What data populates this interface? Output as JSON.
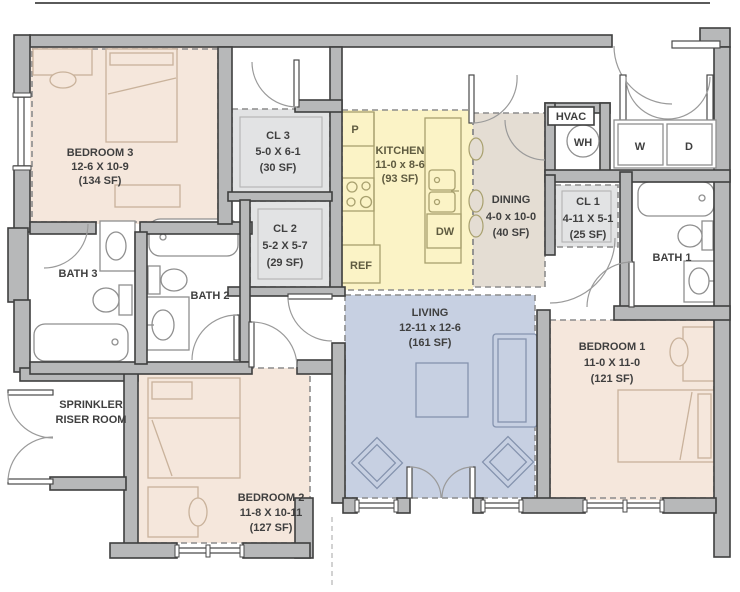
{
  "plan": {
    "title": "Unit floor plan",
    "rooms": {
      "bedroom3": {
        "name": "BEDROOM 3",
        "dims": "12-6 X 10-9",
        "area": "(134 SF)"
      },
      "bedroom2": {
        "name": "BEDROOM 2",
        "dims": "11-8 X 10-11",
        "area": "(127 SF)"
      },
      "bedroom1": {
        "name": "BEDROOM 1",
        "dims": "11-0 X 11-0",
        "area": "(121 SF)"
      },
      "living": {
        "name": "LIVING",
        "dims": "12-11 x 12-6",
        "area": "(161 SF)"
      },
      "kitchen": {
        "name": "KITCHEN",
        "dims": "11-0 x 8-6",
        "area": "(93 SF)"
      },
      "dining": {
        "name": "DINING",
        "dims": "4-0 x 10-0",
        "area": "(40 SF)"
      },
      "cl1": {
        "name": "CL 1",
        "dims": "4-11 X 5-1",
        "area": "(25 SF)"
      },
      "cl2": {
        "name": "CL 2",
        "dims": "5-2 X 5-7",
        "area": "(29 SF)"
      },
      "cl3": {
        "name": "CL 3",
        "dims": "5-0 X 6-1",
        "area": "(30 SF)"
      },
      "bath1": {
        "name": "BATH 1"
      },
      "bath2": {
        "name": "BATH 2"
      },
      "bath3": {
        "name": "BATH 3"
      },
      "hvac": {
        "name": "HVAC"
      },
      "sprinkler": {
        "name_line1": "SPRINKLER",
        "name_line2": "RISER ROOM"
      }
    },
    "appliances": {
      "pantry": "P",
      "refrigerator": "REF",
      "dishwasher": "DW",
      "water_heater": "WH",
      "washer": "W",
      "dryer": "D"
    },
    "colors": {
      "wall_fill": "#b7b8b9",
      "wall_stroke": "#3f3f3f",
      "bedroom_fill": "#f5e7dc",
      "kitchen_fill": "#fbf3c6",
      "dining_fill": "#e4ddd3",
      "living_fill": "#c7d0e2",
      "closet_fill": "#e2e3e4",
      "label_text": "#3f3f3f",
      "kitchen_text": "#5f5b40",
      "dash": "#8c8c8c",
      "fixture_stroke": "#8f8f8f",
      "bedroom_furniture": "#c9b29b",
      "living_furniture": "#8593ae",
      "kitchen_furniture": "#a8a06e"
    }
  }
}
